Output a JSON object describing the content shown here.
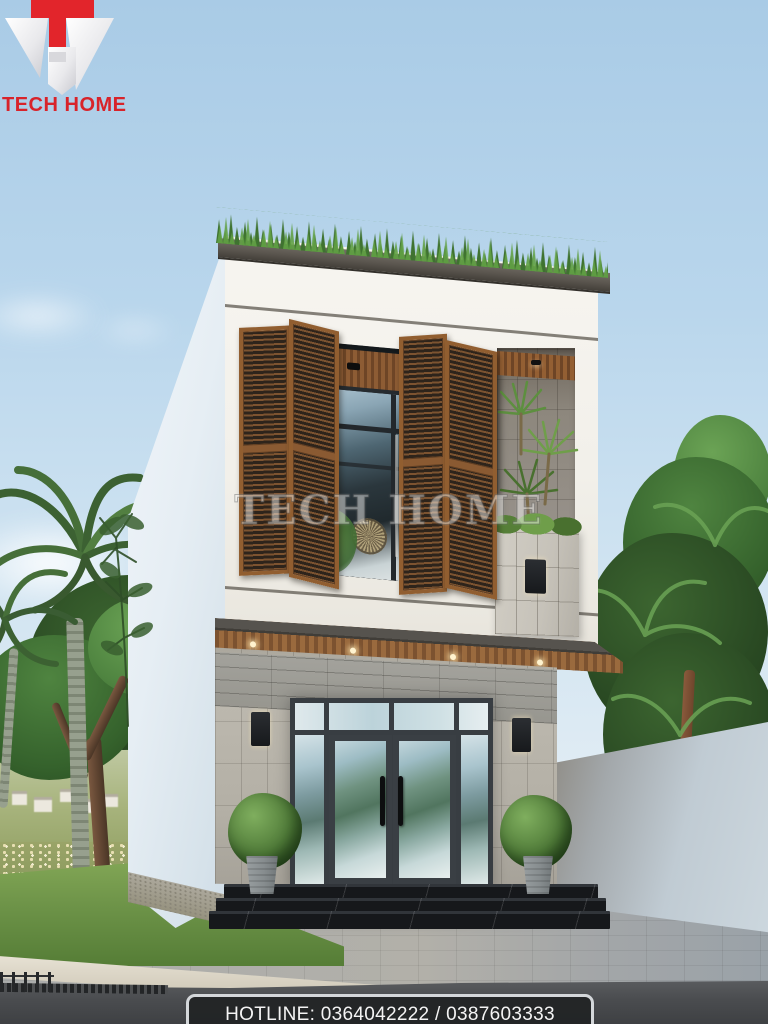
{
  "branding": {
    "logo_text": "TECH HOME",
    "brand_red": "#d8232a",
    "logo_mark": "red-letter-T-over-silver-diamond-H"
  },
  "watermark": {
    "text": "TECH HOME"
  },
  "footer": {
    "hotline_text": "HOTLINE: 0364042222 / 0387603333"
  },
  "scene": {
    "type": "architectural-exterior-render",
    "subject": "Modern two-storey narrow townhouse, front elevation, daytime",
    "elements": [
      "flat roof with parapet grass planting",
      "white second-storey box with large opening and wooden bi-fold louver shutters",
      "recessed niche with tropical plants and stone planter box with wall lamp",
      "wood-slat canopy awning with downlights",
      "grey stone-clad ground floor with glass double entry door and sidelights",
      "two wall sconces, two topiary ball plants in concrete pots",
      "three black marble entry steps, paver forecourt, lawn, curb and asphalt road",
      "palm trees and leafy trees left, dense tropical foliage and white boundary wall right",
      "distant village and flower field at lower left"
    ],
    "palette": {
      "sky_top": "#a9cbe6",
      "facade_white": "#f2f0ea",
      "roof_cap_grey": "#5b564f",
      "shutter_wood": "#8d5c34",
      "stone_cladding": "#b3afa5",
      "door_frame": "#383d42",
      "marble_step": "#16181b",
      "foliage_dark": "#2a4a23",
      "foliage_light": "#6ba355",
      "paver_grey": "#aaacab",
      "hotline_bg": "#212325",
      "hotline_border": "#d4d7da"
    }
  }
}
